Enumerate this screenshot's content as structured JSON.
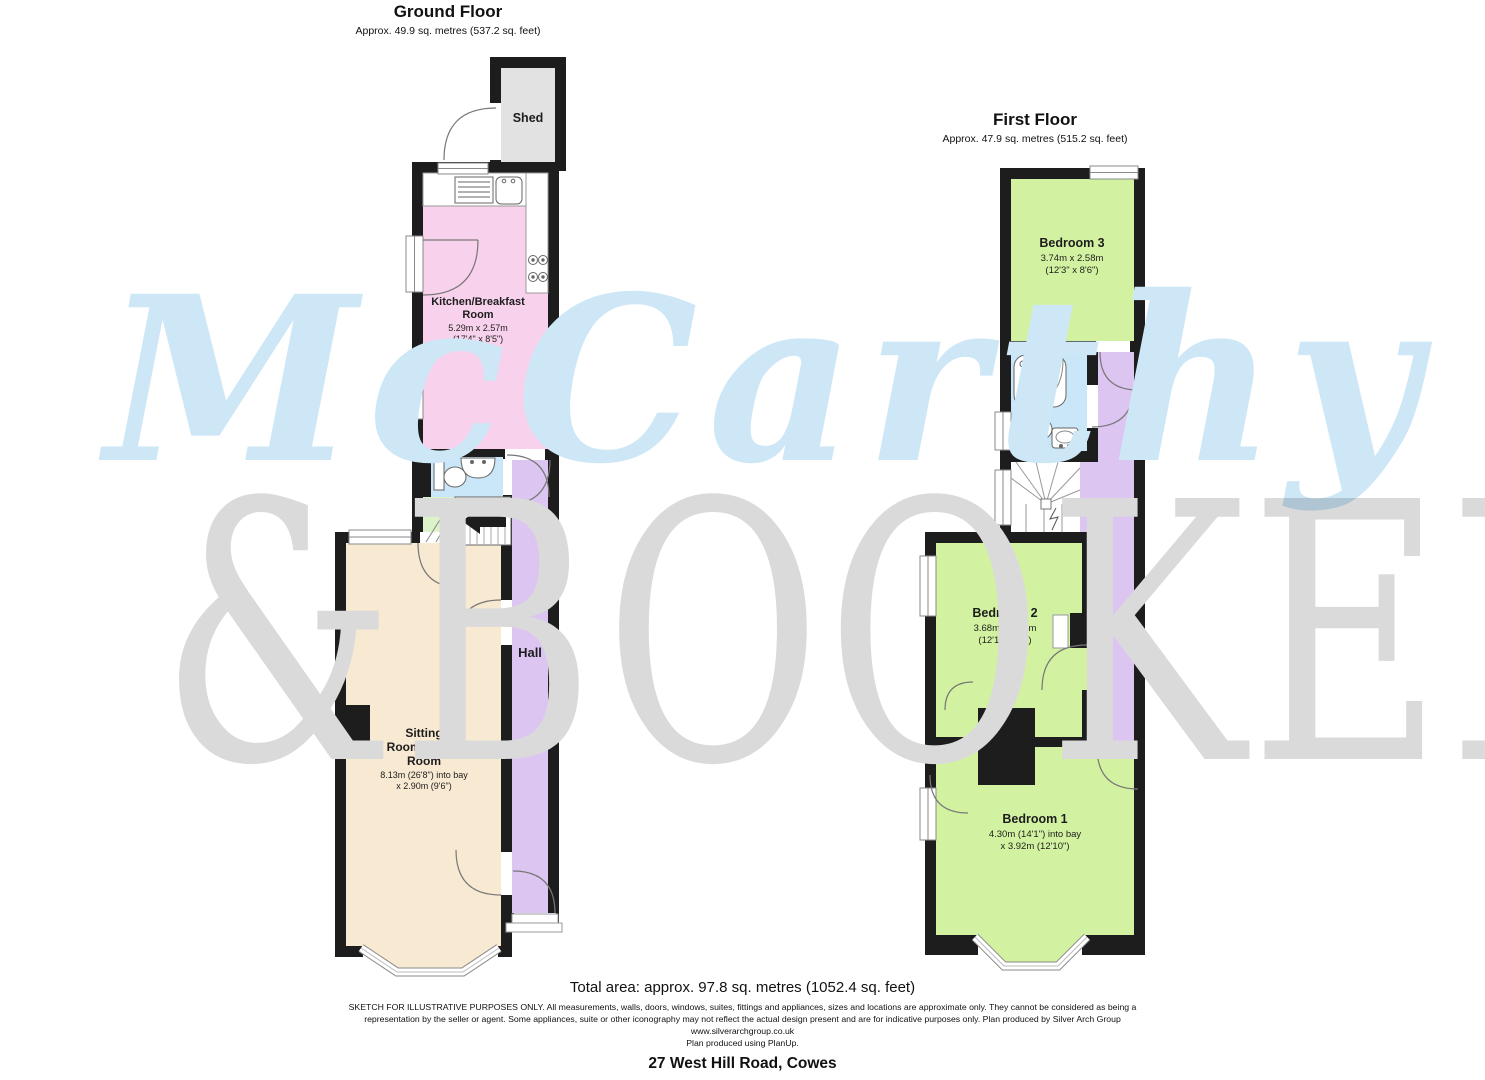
{
  "ground_floor": {
    "title": "Ground Floor",
    "subtitle": "Approx. 49.9 sq. metres (537.2 sq. feet)",
    "rooms": {
      "shed": {
        "label": "Shed"
      },
      "kitchen": {
        "line1": "Kitchen/Breakfast",
        "line2": "Room",
        "dim1": "5.29m x 2.57m",
        "dim2": "(17'4\" x 8'5\")"
      },
      "hall": {
        "label": "Hall"
      },
      "sitting": {
        "line1": "Sitting",
        "line2": "Room/Dining",
        "line3": "Room",
        "dim1": "8.13m (26'8\") into bay",
        "dim2": "x 2.90m (9'6\")"
      }
    }
  },
  "first_floor": {
    "title": "First Floor",
    "subtitle": "Approx. 47.9 sq. metres (515.2 sq. feet)",
    "rooms": {
      "bedroom3": {
        "label": "Bedroom 3",
        "dim1": "3.74m x 2.58m",
        "dim2": "(12'3\" x 8'6\")"
      },
      "bedroom2": {
        "label": "Bedroom 2",
        "dim1": "3.68m x 2.93m",
        "dim2": "(12'1\" x 9'7\")"
      },
      "bedroom1": {
        "label": "Bedroom 1",
        "dim1": "4.30m (14'1\") into bay",
        "dim2": "x 3.92m (12'10\")"
      }
    }
  },
  "watermark": {
    "line1": "McCarthy",
    "line2": "&BOOKER"
  },
  "footer": {
    "total_area": "Total area: approx. 97.8 sq. metres (1052.4 sq. feet)",
    "disclaimer_line1": "SKETCH FOR ILLUSTRATIVE PURPOSES ONLY. All measurements, walls, doors, windows, suites, fittings and appliances, sizes and locations are approximate only. They cannot be considered as being a",
    "disclaimer_line2": "representation by the seller or agent. Some appliances, suite or other iconography may not reflect the actual design present and are for indicative purposes only. Plan produced by Silver Arch Group",
    "website": "www.silverarchgroup.co.uk",
    "produced_with": "Plan produced using PlanUp.",
    "address": "27 West Hill Road, Cowes"
  },
  "colors": {
    "wall": "#1d1d1d",
    "kitchen": "#f8d2ec",
    "hall_landing": "#ddc5f2",
    "sitting_room": "#f8e9d2",
    "bedroom": "#d3f2a1",
    "bathroom": "#c9e7f8",
    "shed": "#e2e2e2",
    "understairs": "#dcf3c9",
    "watermark_blue": "#cde7f7",
    "watermark_grey": "#dadada"
  }
}
